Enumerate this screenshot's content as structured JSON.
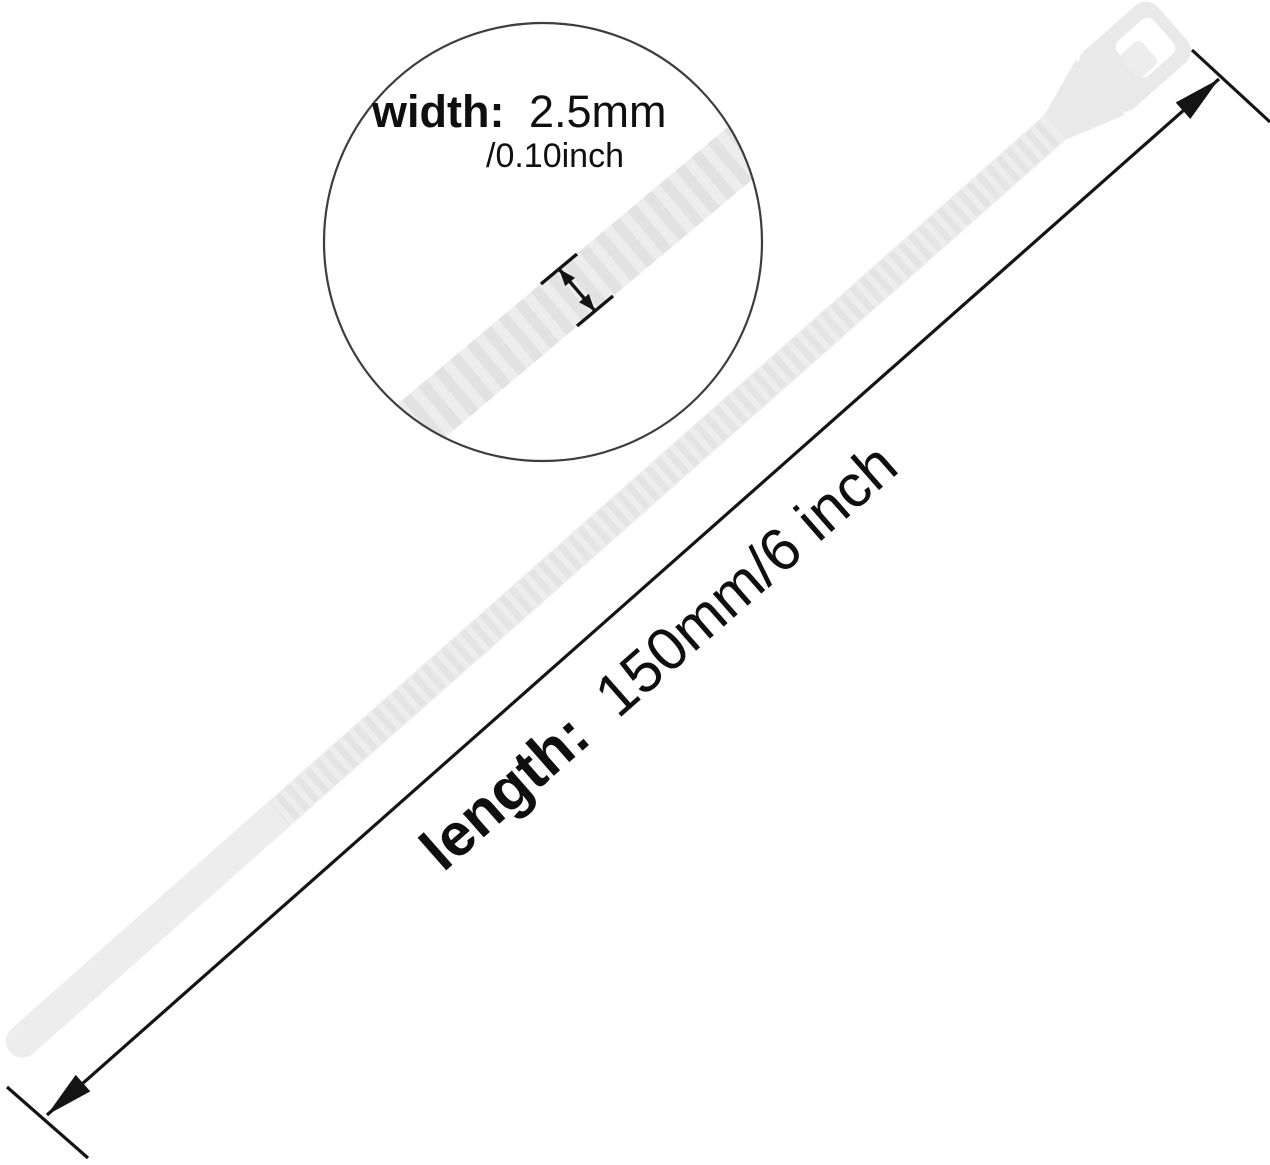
{
  "magnifier": {
    "width_label": "width:",
    "width_value_metric": "2.5mm",
    "width_value_imperial": "/0.10inch"
  },
  "length_dimension": {
    "label": "length:",
    "value": "150mm/6 inch"
  },
  "icons": {
    "width_arrow": "double-headed-arrow",
    "length_arrow": "double-headed-arrow-with-extension-ticks",
    "magnifier": "zoom-detail-circle"
  },
  "colors": {
    "background": "#ffffff",
    "annotation": "#141414",
    "text": "#0f0f0f",
    "tie_fill": "#ededed",
    "tie_head_fill": "#e9e9e9",
    "tie_tooth": "#e4e4e4",
    "tie_tooth_zoom": "#e2e2e2",
    "tie_hole_fill": "#ffffff",
    "magnifier_stroke": "#3d3d3d"
  }
}
